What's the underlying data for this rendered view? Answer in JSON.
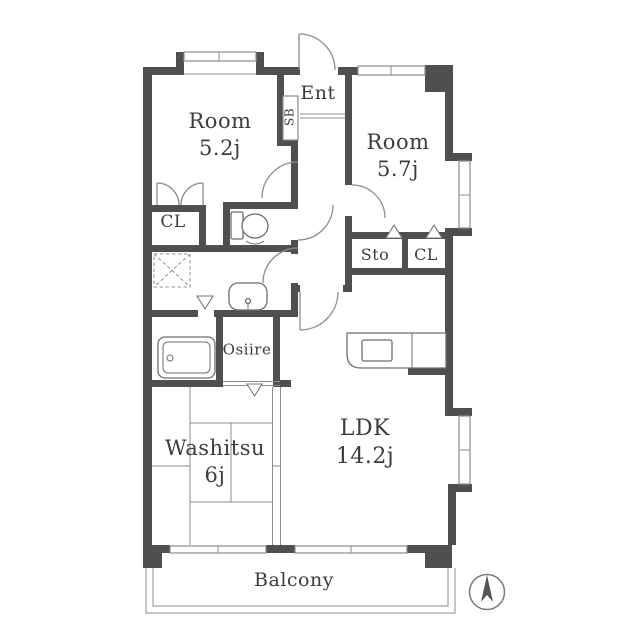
{
  "colors": {
    "wall": "#4f4f4f",
    "line": "#8c8c8c",
    "text": "#3c3c3c"
  },
  "labels": {
    "room_nw": {
      "name": "Room",
      "size": "5.2j"
    },
    "room_ne": {
      "name": "Room",
      "size": "5.7j"
    },
    "entrance": "Ent",
    "shoe_box": "SB",
    "closet_west": "CL",
    "storage": "Sto",
    "closet_east": "CL",
    "oshiire": "Osiire",
    "washitsu": {
      "name": "Washitsu",
      "size": "6j"
    },
    "ldk": {
      "name": "LDK",
      "size": "14.2j"
    },
    "balcony": "Balcony"
  }
}
